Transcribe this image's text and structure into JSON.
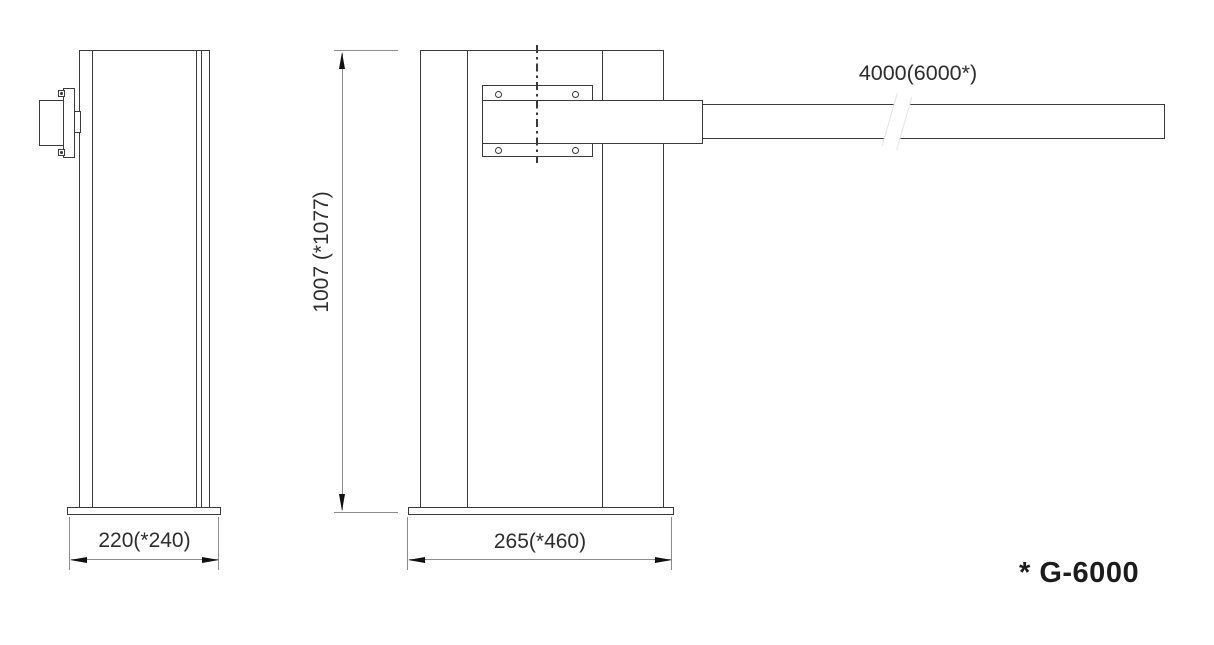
{
  "labels": {
    "arm_length": "4000(6000*)",
    "pillar_height": "1007 (*1077)",
    "side_width": "220(*240)",
    "front_width": "265(*460)",
    "model_note": "* G-6000"
  },
  "colors": {
    "outline": "#3a3a3a",
    "dimension_line": "#8c8c8c",
    "arrowhead": "#111111",
    "text": "#2d2d2d",
    "background": "#ffffff"
  }
}
